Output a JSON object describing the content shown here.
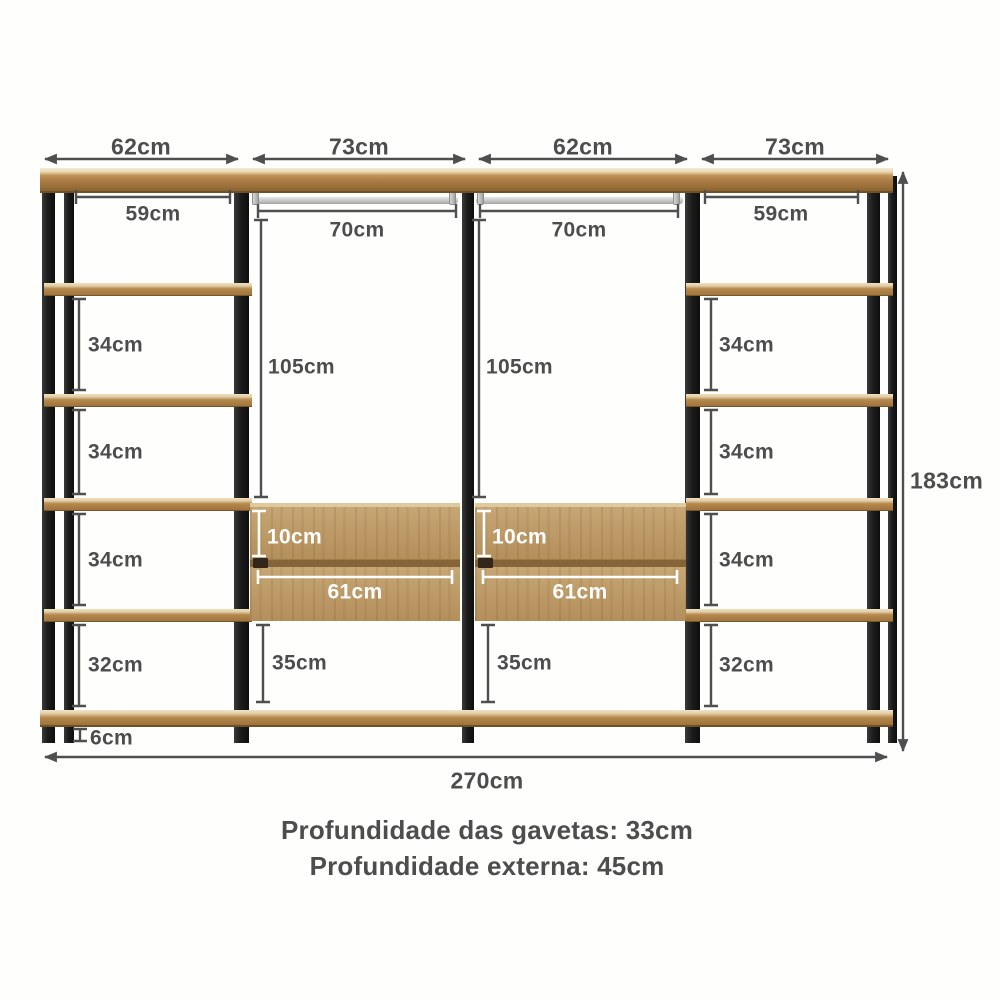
{
  "figure": {
    "top_dims": [
      "62cm",
      "73cm",
      "62cm",
      "73cm"
    ],
    "inner_top_dims": [
      "59cm",
      "70cm",
      "70cm",
      "59cm"
    ],
    "hang_heights": [
      "105cm",
      "105cm"
    ],
    "left_gaps": [
      "34cm",
      "34cm",
      "34cm",
      "32cm"
    ],
    "right_gaps": [
      "34cm",
      "34cm",
      "34cm",
      "32cm"
    ],
    "drawer_heights": [
      "10cm",
      "10cm"
    ],
    "drawer_widths": [
      "61cm",
      "61cm"
    ],
    "below_drawer_gaps": [
      "35cm",
      "35cm"
    ],
    "floor_gap": "6cm",
    "total_height": "183cm",
    "total_width": "270cm"
  },
  "captions": {
    "drawer_depth": "Profundidade das gavetas: 33cm",
    "external_depth": "Profundidade externa: 45cm"
  },
  "colors": {
    "frame": "#1c1c1c",
    "shelf_wood": "#a87c44",
    "drawer_wood": "#c09a62",
    "rod": "#cccccc",
    "dimension": "#4d4d4d",
    "background": "#ffffff"
  }
}
